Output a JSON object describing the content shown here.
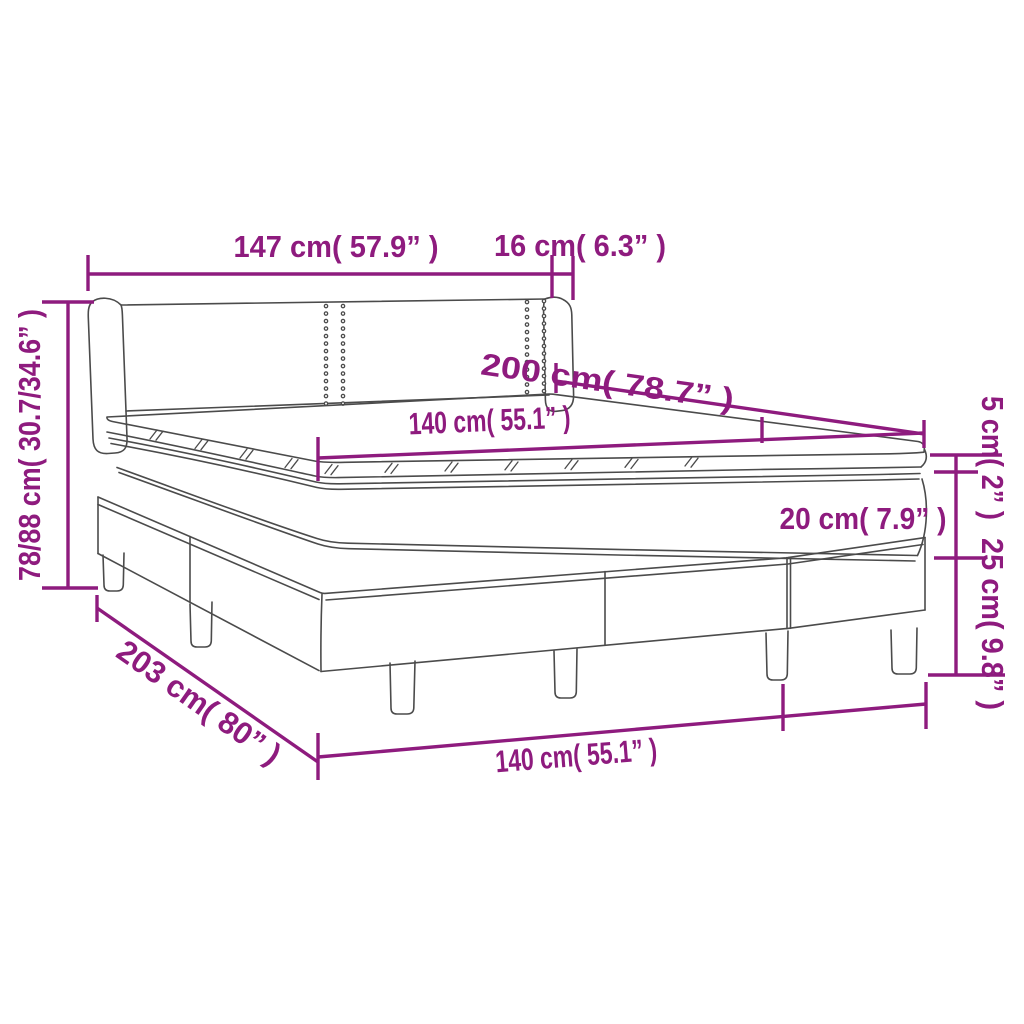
{
  "diagram": {
    "title": "Box spring bed with mattress and topper — dimension diagram",
    "accent_color": "#8e1b7e",
    "line_color": "#4b4b4b",
    "background_color": "#ffffff",
    "labels": {
      "headboard_width": "147 cm( 57.9” )",
      "wing_depth": "16 cm( 6.3” )",
      "total_height": "78/88 cm( 30.7/34.6” )",
      "mattress_width": "140 cm( 55.1” )",
      "bed_length": "200 cm( 78.7” )",
      "mattress_height": "20 cm( 7.9” )",
      "topper_height": "5 cm( 2” )",
      "base_height": "25 cm( 9.8” )",
      "total_length": "203 cm( 80” )",
      "bed_width": "140 cm( 55.1” )"
    },
    "dimensions": [
      {
        "part": "headboard width",
        "cm": "147",
        "inches": "57.9"
      },
      {
        "part": "headboard wing depth",
        "cm": "16",
        "inches": "6.3"
      },
      {
        "part": "total height",
        "cm": "78/88",
        "inches": "30.7/34.6"
      },
      {
        "part": "mattress width (top)",
        "cm": "140",
        "inches": "55.1"
      },
      {
        "part": "bed length",
        "cm": "200",
        "inches": "78.7"
      },
      {
        "part": "mattress height",
        "cm": "20",
        "inches": "7.9"
      },
      {
        "part": "topper height",
        "cm": "5",
        "inches": "2"
      },
      {
        "part": "base height",
        "cm": "25",
        "inches": "9.8"
      },
      {
        "part": "total length",
        "cm": "203",
        "inches": "80"
      },
      {
        "part": "bed width (bottom)",
        "cm": "140",
        "inches": "55.1"
      }
    ]
  }
}
